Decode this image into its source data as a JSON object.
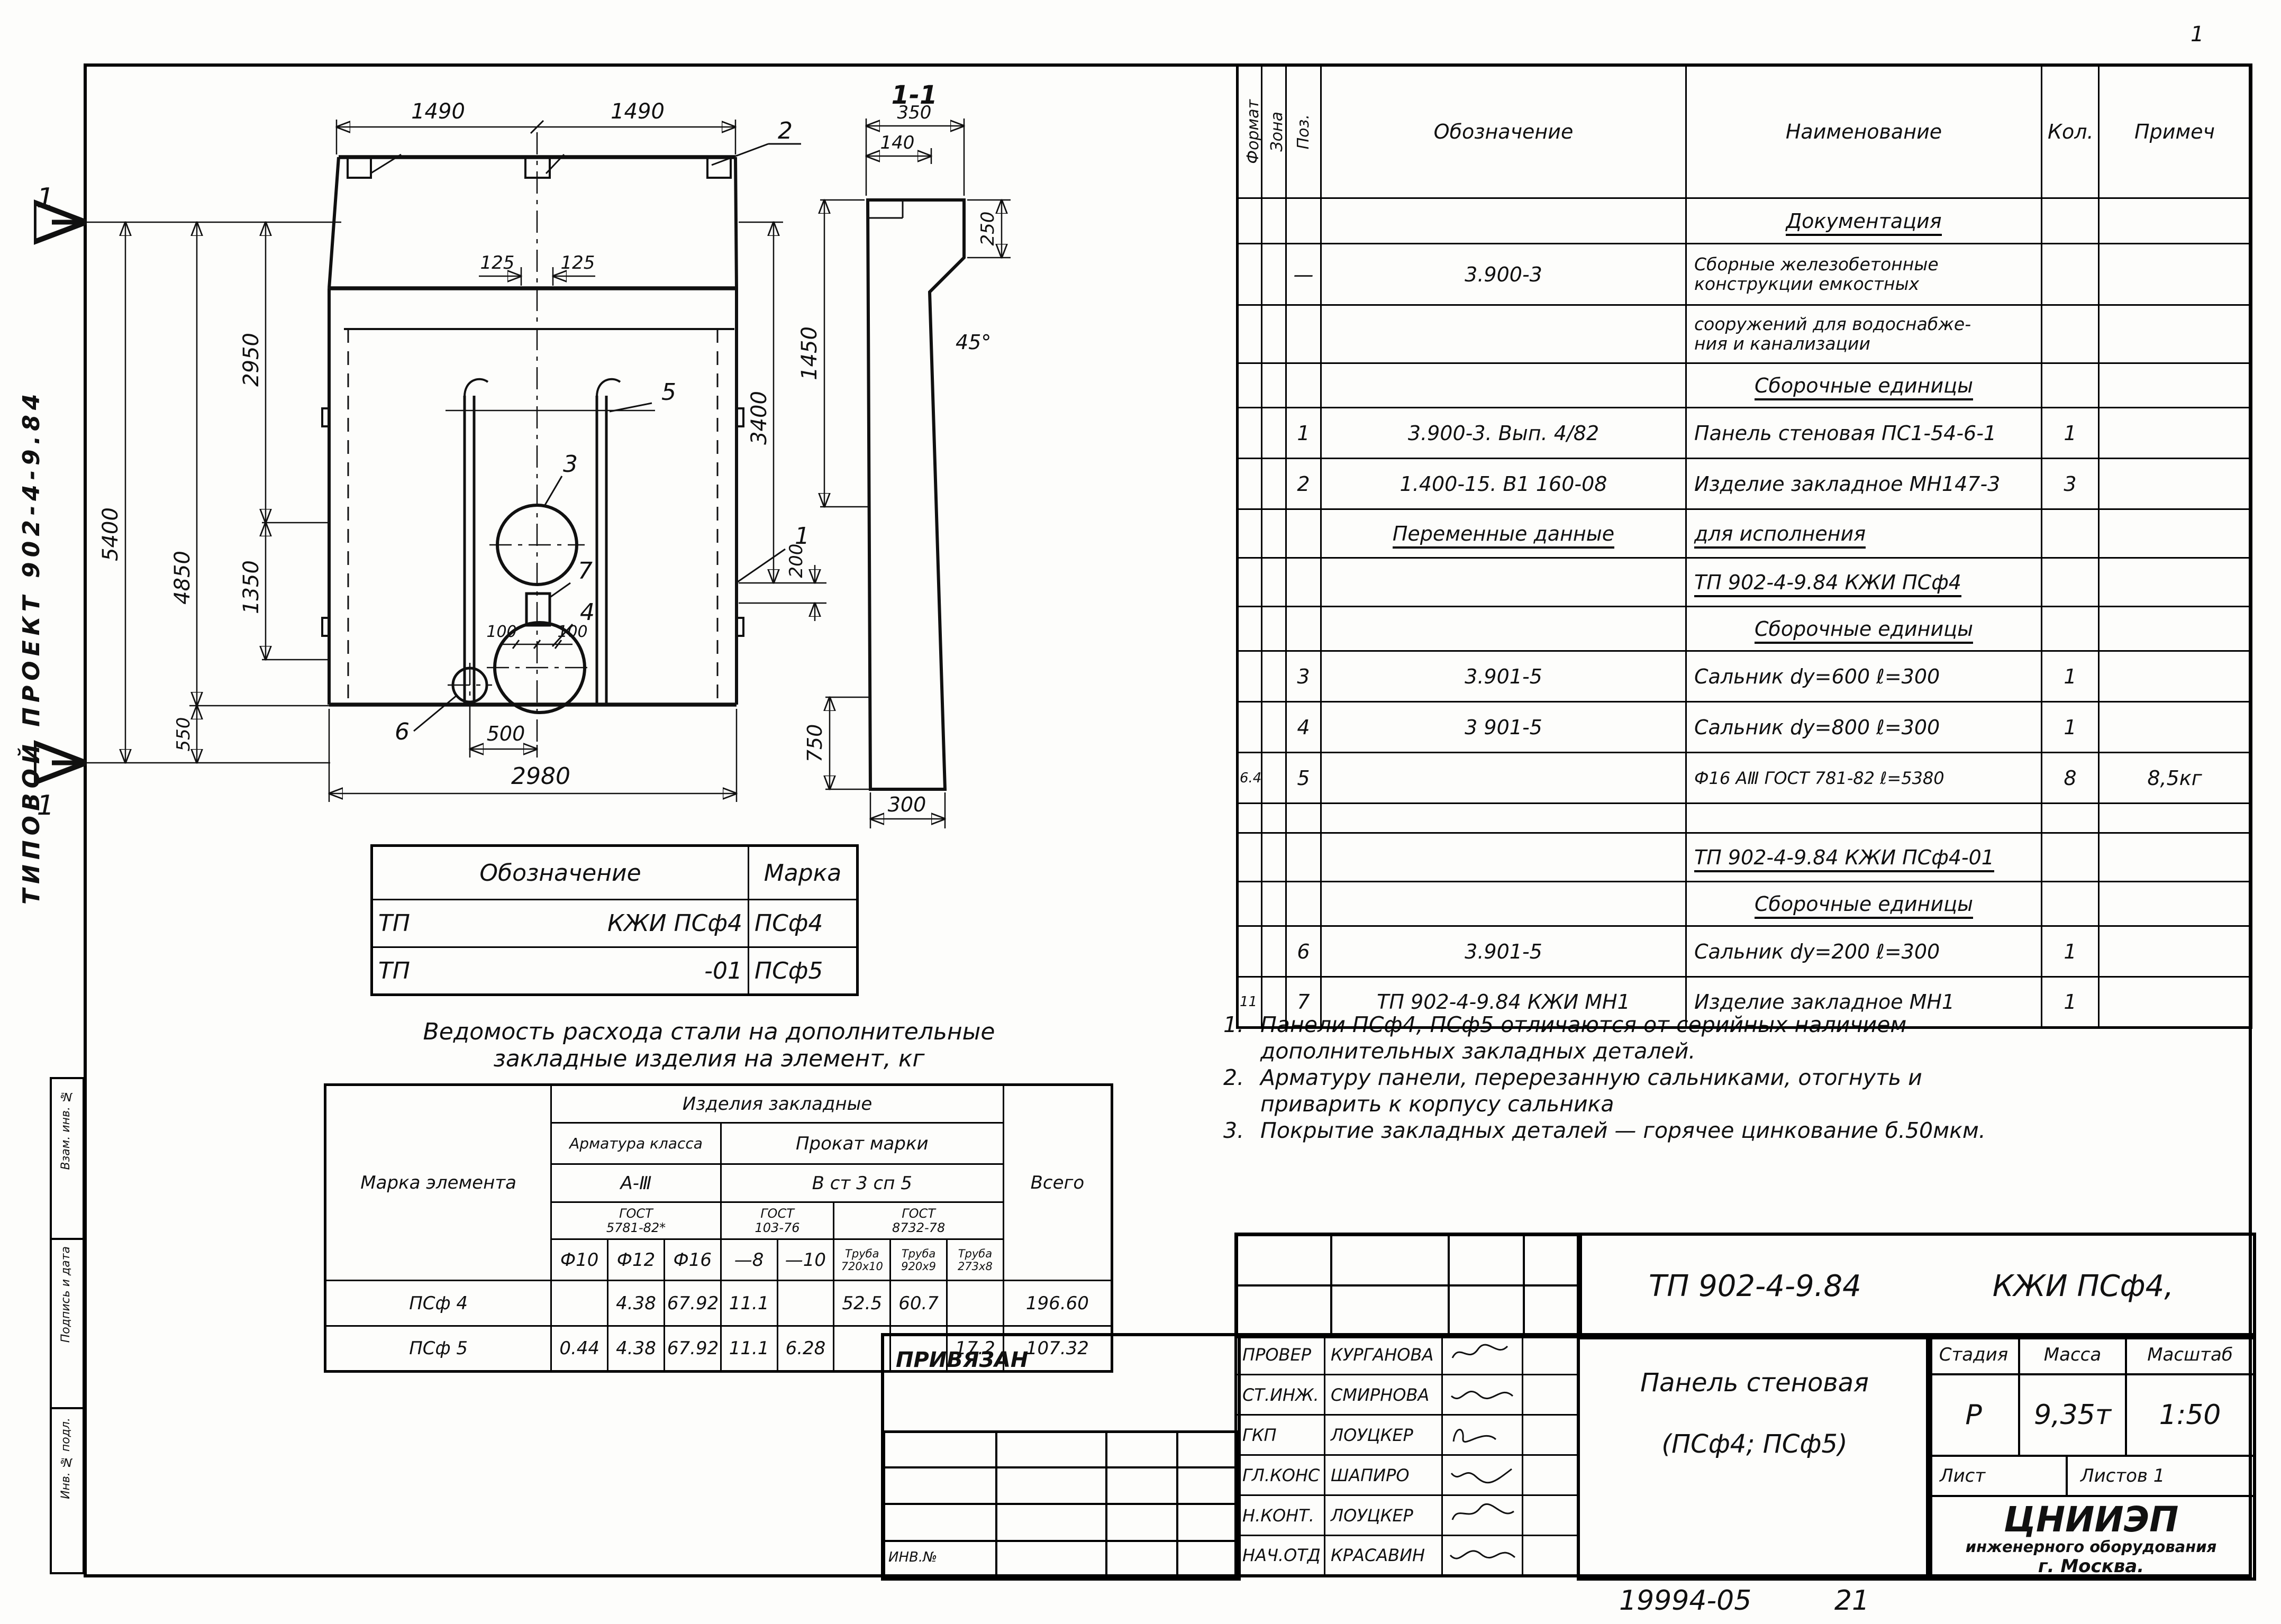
{
  "page": {
    "corner_sheet_no": "1",
    "footer_number": "19994-05",
    "footer_sheet": "21"
  },
  "margin": {
    "vertical_label": "ТИПОВОЙ   ПРОЕКТ   902-4-9.84",
    "stamp_cells": [
      "Взам. инв. №",
      "Подпись и дата",
      "Инв. № подл."
    ]
  },
  "drawing": {
    "section_title": "1-1",
    "dims": {
      "w1": "1490",
      "w2": "1490",
      "o1": "125",
      "o2": "125",
      "h_total": "5400",
      "h1": "4850",
      "h2": "2950",
      "h3": "1350",
      "h4": "550",
      "w_bottom": "2980",
      "hole_offset": "500",
      "right_height": "3400",
      "right_gap": "200",
      "g1": "100",
      "g2": "100",
      "s_350": "350",
      "s_140": "140",
      "s_250": "250",
      "s_45": "45°",
      "s_1450": "1450",
      "s_750": "750",
      "s_300": "300"
    },
    "callouts": {
      "c1": "1",
      "c2": "2",
      "c3": "3",
      "c4": "4",
      "c5": "5",
      "c6": "6",
      "c7": "7",
      "section_mark_top": "1",
      "section_mark_bottom": "1"
    }
  },
  "mark_table": {
    "headers": {
      "oboznachenie": "Обозначение",
      "marka": "Марка"
    },
    "rows": [
      {
        "left": "ТП",
        "right": "КЖИ ПСф4",
        "marka": "ПСф4"
      },
      {
        "left": "ТП",
        "right": "-01",
        "marka": "ПСф5"
      }
    ]
  },
  "steel_table": {
    "title1": "Ведомость расхода стали на дополнительные",
    "title2": "закладные  изделия  на элемент, кг",
    "marka_label": "Марка элемента",
    "group_label": "Изделия  закладные",
    "armatura_label": "Арматура класса",
    "prokat_label": "Прокат марки",
    "klass_label": "А-Ⅲ",
    "stal_label": "В ст 3 сп 5",
    "gost1a": "ГОСТ",
    "gost1b": "5781-82*",
    "gost2a": "ГОСТ",
    "gost2b": "103-76",
    "gost3a": "ГОСТ",
    "gost3b": "8732-78",
    "vsego_label": "Всего",
    "cols": [
      "Ф10",
      "Ф12",
      "Ф16",
      "—8",
      "—10",
      "Труба 720х10",
      "Труба 920х9",
      "Труба 273х8"
    ],
    "rows": [
      {
        "marka": "ПСф 4",
        "v": [
          "",
          "4.38",
          "67.92",
          "11.1",
          "",
          "52.5",
          "60.7",
          ""
        ],
        "total": "196.60"
      },
      {
        "marka": "ПСф 5",
        "v": [
          "0.44",
          "4.38",
          "67.92",
          "11.1",
          "6.28",
          "",
          "",
          "17.2"
        ],
        "total": "107.32"
      }
    ]
  },
  "notes": [
    {
      "num": "1.",
      "l1": "Панели ПСф4, ПСф5 отличаются от серийных наличием",
      "l2": "дополнительных закладных деталей."
    },
    {
      "num": "2.",
      "l1": "Арматуру панели, перерезанную сальниками, отогнуть и",
      "l2": "приварить к корпусу сальника"
    },
    {
      "num": "3.",
      "l1": "Покрытие закладных деталей — горячее цинкование  б.50мкм.",
      "l2": ""
    }
  ],
  "spec": {
    "headers": {
      "format": "Формат",
      "zona": "Зона",
      "poz": "Поз.",
      "obozn": "Обозначение",
      "naim": "Наименование",
      "kol": "Кол.",
      "prim": "Примеч"
    },
    "rows": [
      {
        "n": "Документация"
      },
      {
        "p": "—",
        "o": "3.900-3",
        "n": "Сборные железобетонные",
        "n2": "конструкции емкостных"
      },
      {
        "n": "сооружений для водоснабже-",
        "n2": "ния и канализации"
      },
      {
        "n": "Сборочные  единицы"
      },
      {
        "p": "1",
        "o": "3.900-3.    Вып. 4/82",
        "n": "Панель стеновая ПС1-54-6-1",
        "k": "1"
      },
      {
        "p": "2",
        "o": "1.400-15. В1  160-08",
        "n": "Изделие закладное  МН147-3",
        "k": "3"
      },
      {
        "o": "Переменные  данные",
        "n": "для исполнения"
      },
      {
        "n": "ТП 902-4-9.84  КЖИ  ПСф4"
      },
      {
        "n": "Сборочные  единицы"
      },
      {
        "p": "3",
        "o": "3.901-5",
        "n": "Сальник  dу=600   ℓ=300",
        "k": "1"
      },
      {
        "p": "4",
        "o": "3 901-5",
        "n": "Сальник  dу=800   ℓ=300",
        "k": "1"
      },
      {
        "f": "6.4",
        "p": "5",
        "o": "",
        "n": "Ф16 АⅢ ГОСТ 781-82  ℓ=5380",
        "k": "8",
        "pr": "8,5кг"
      },
      {},
      {
        "n": "ТП 902-4-9.84 КЖИ ПСф4-01"
      },
      {
        "n": "Сборочные  единицы"
      },
      {
        "p": "6",
        "o": "3.901-5",
        "n": "Сальник  dу=200   ℓ=300",
        "k": "1"
      },
      {
        "f": "11",
        "p": "7",
        "o": "ТП 902-4-9.84  КЖИ   МН1",
        "n": "Изделие закладное МН1",
        "k": "1"
      }
    ]
  },
  "title_block": {
    "doc_code": "ТП 902-4-9.84",
    "doc_code2": "КЖИ  ПСф4,",
    "name1": "Панель  стеновая",
    "name2": "(ПСф4; ПСф5)",
    "stage_label": "Стадия",
    "mass_label": "Масса",
    "scale_label": "Масштаб",
    "stage": "Р",
    "mass": "9,35т",
    "scale": "1:50",
    "sheet_label": "Лист",
    "sheets_label": "Листов 1",
    "org1": "ЦНИИЭП",
    "org2": "инженерного оборудования",
    "org3": "г. Москва."
  },
  "signature_block": {
    "attached_label": "ПРИВЯЗАН",
    "inv_label": "ИНВ.№",
    "rows": [
      {
        "role": "ПРОВЕР",
        "name": "КУРГАНОВА"
      },
      {
        "role": "СТ.ИНЖ.",
        "name": "СМИРНОВА"
      },
      {
        "role": "ГКП",
        "name": "ЛОУЦКЕР"
      },
      {
        "role": "ГЛ.КОНС",
        "name": "ШАПИРО"
      },
      {
        "role": "Н.КОНТ.",
        "name": "ЛОУЦКЕР"
      },
      {
        "role": "НАЧ.ОТД",
        "name": "КРАСАВИН"
      }
    ]
  }
}
